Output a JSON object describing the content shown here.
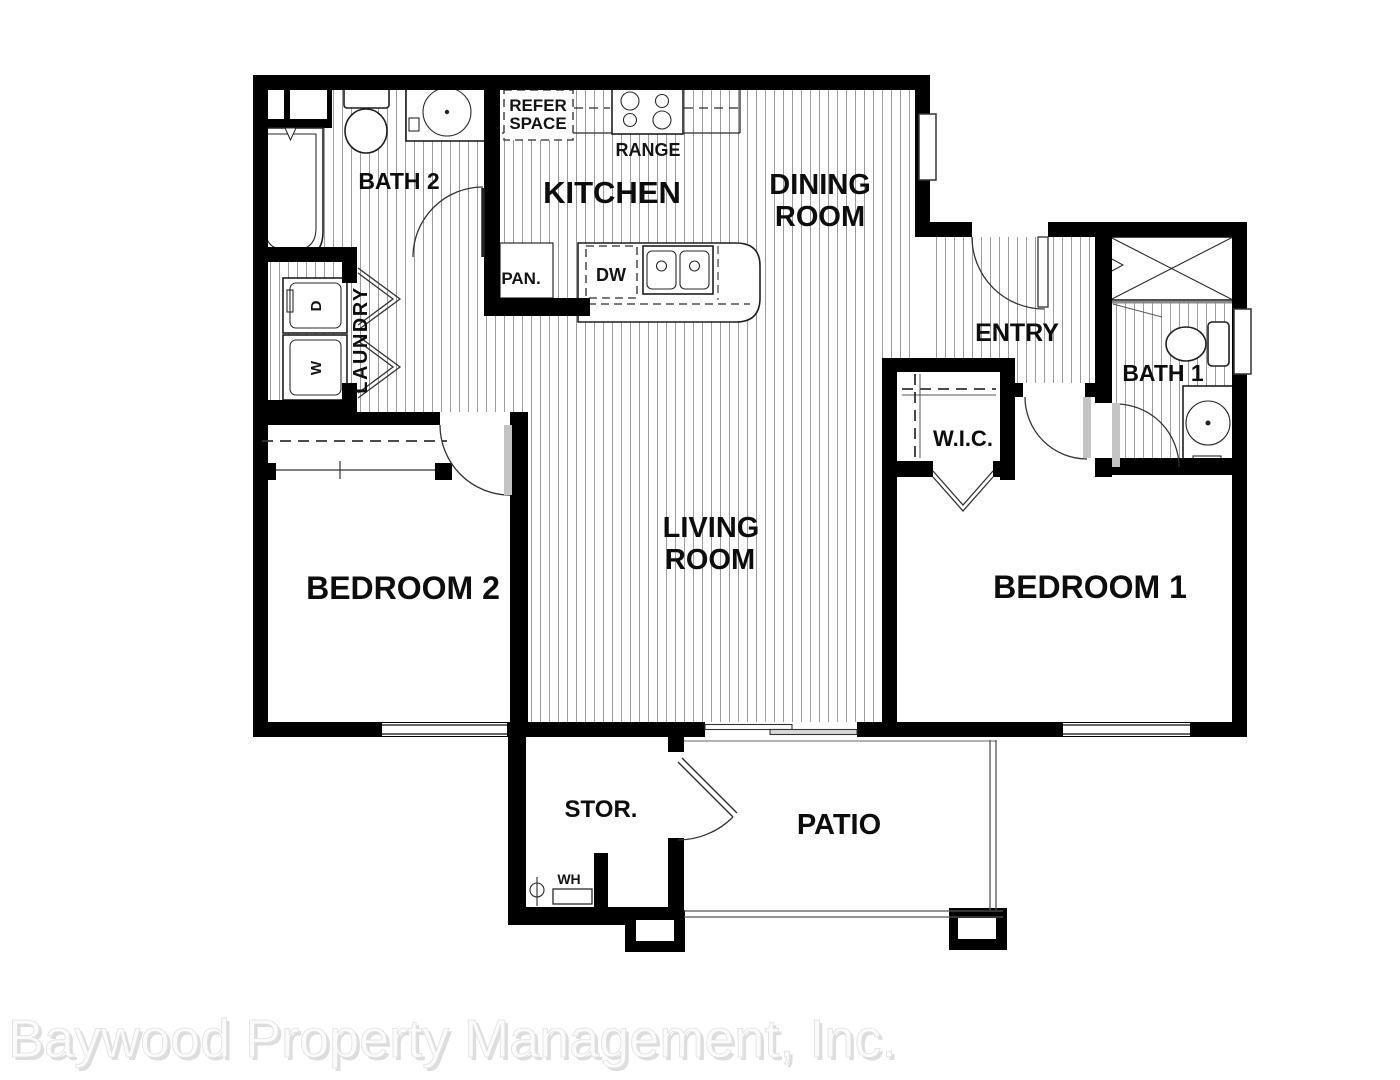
{
  "watermark": "Baywood Property Management, Inc.",
  "rooms": {
    "bath2": "BATH 2",
    "kitchen": "KITCHEN",
    "dining1": "DINING",
    "dining2": "ROOM",
    "living1": "LIVING",
    "living2": "ROOM",
    "entry": "ENTRY",
    "bath1": "BATH 1",
    "laundry": "LAUNDRY",
    "wic": "W.I.C.",
    "bedroom2": "BEDROOM 2",
    "bedroom1": "BEDROOM 1",
    "storage": "STOR.",
    "patio": "PATIO"
  },
  "fixtures": {
    "refer1": "REFER",
    "refer2": "SPACE",
    "range": "RANGE",
    "pantry": "PAN.",
    "dishwasher": "DW",
    "water_heater": "WH",
    "dryer": "D",
    "washer": "W"
  },
  "colors": {
    "wall": "#000000",
    "hatch": "#9b9b9b",
    "door_leaf": "#c4c4c4",
    "watermark": "#fbfbfb",
    "watermark_shadow": "#dddddd"
  }
}
